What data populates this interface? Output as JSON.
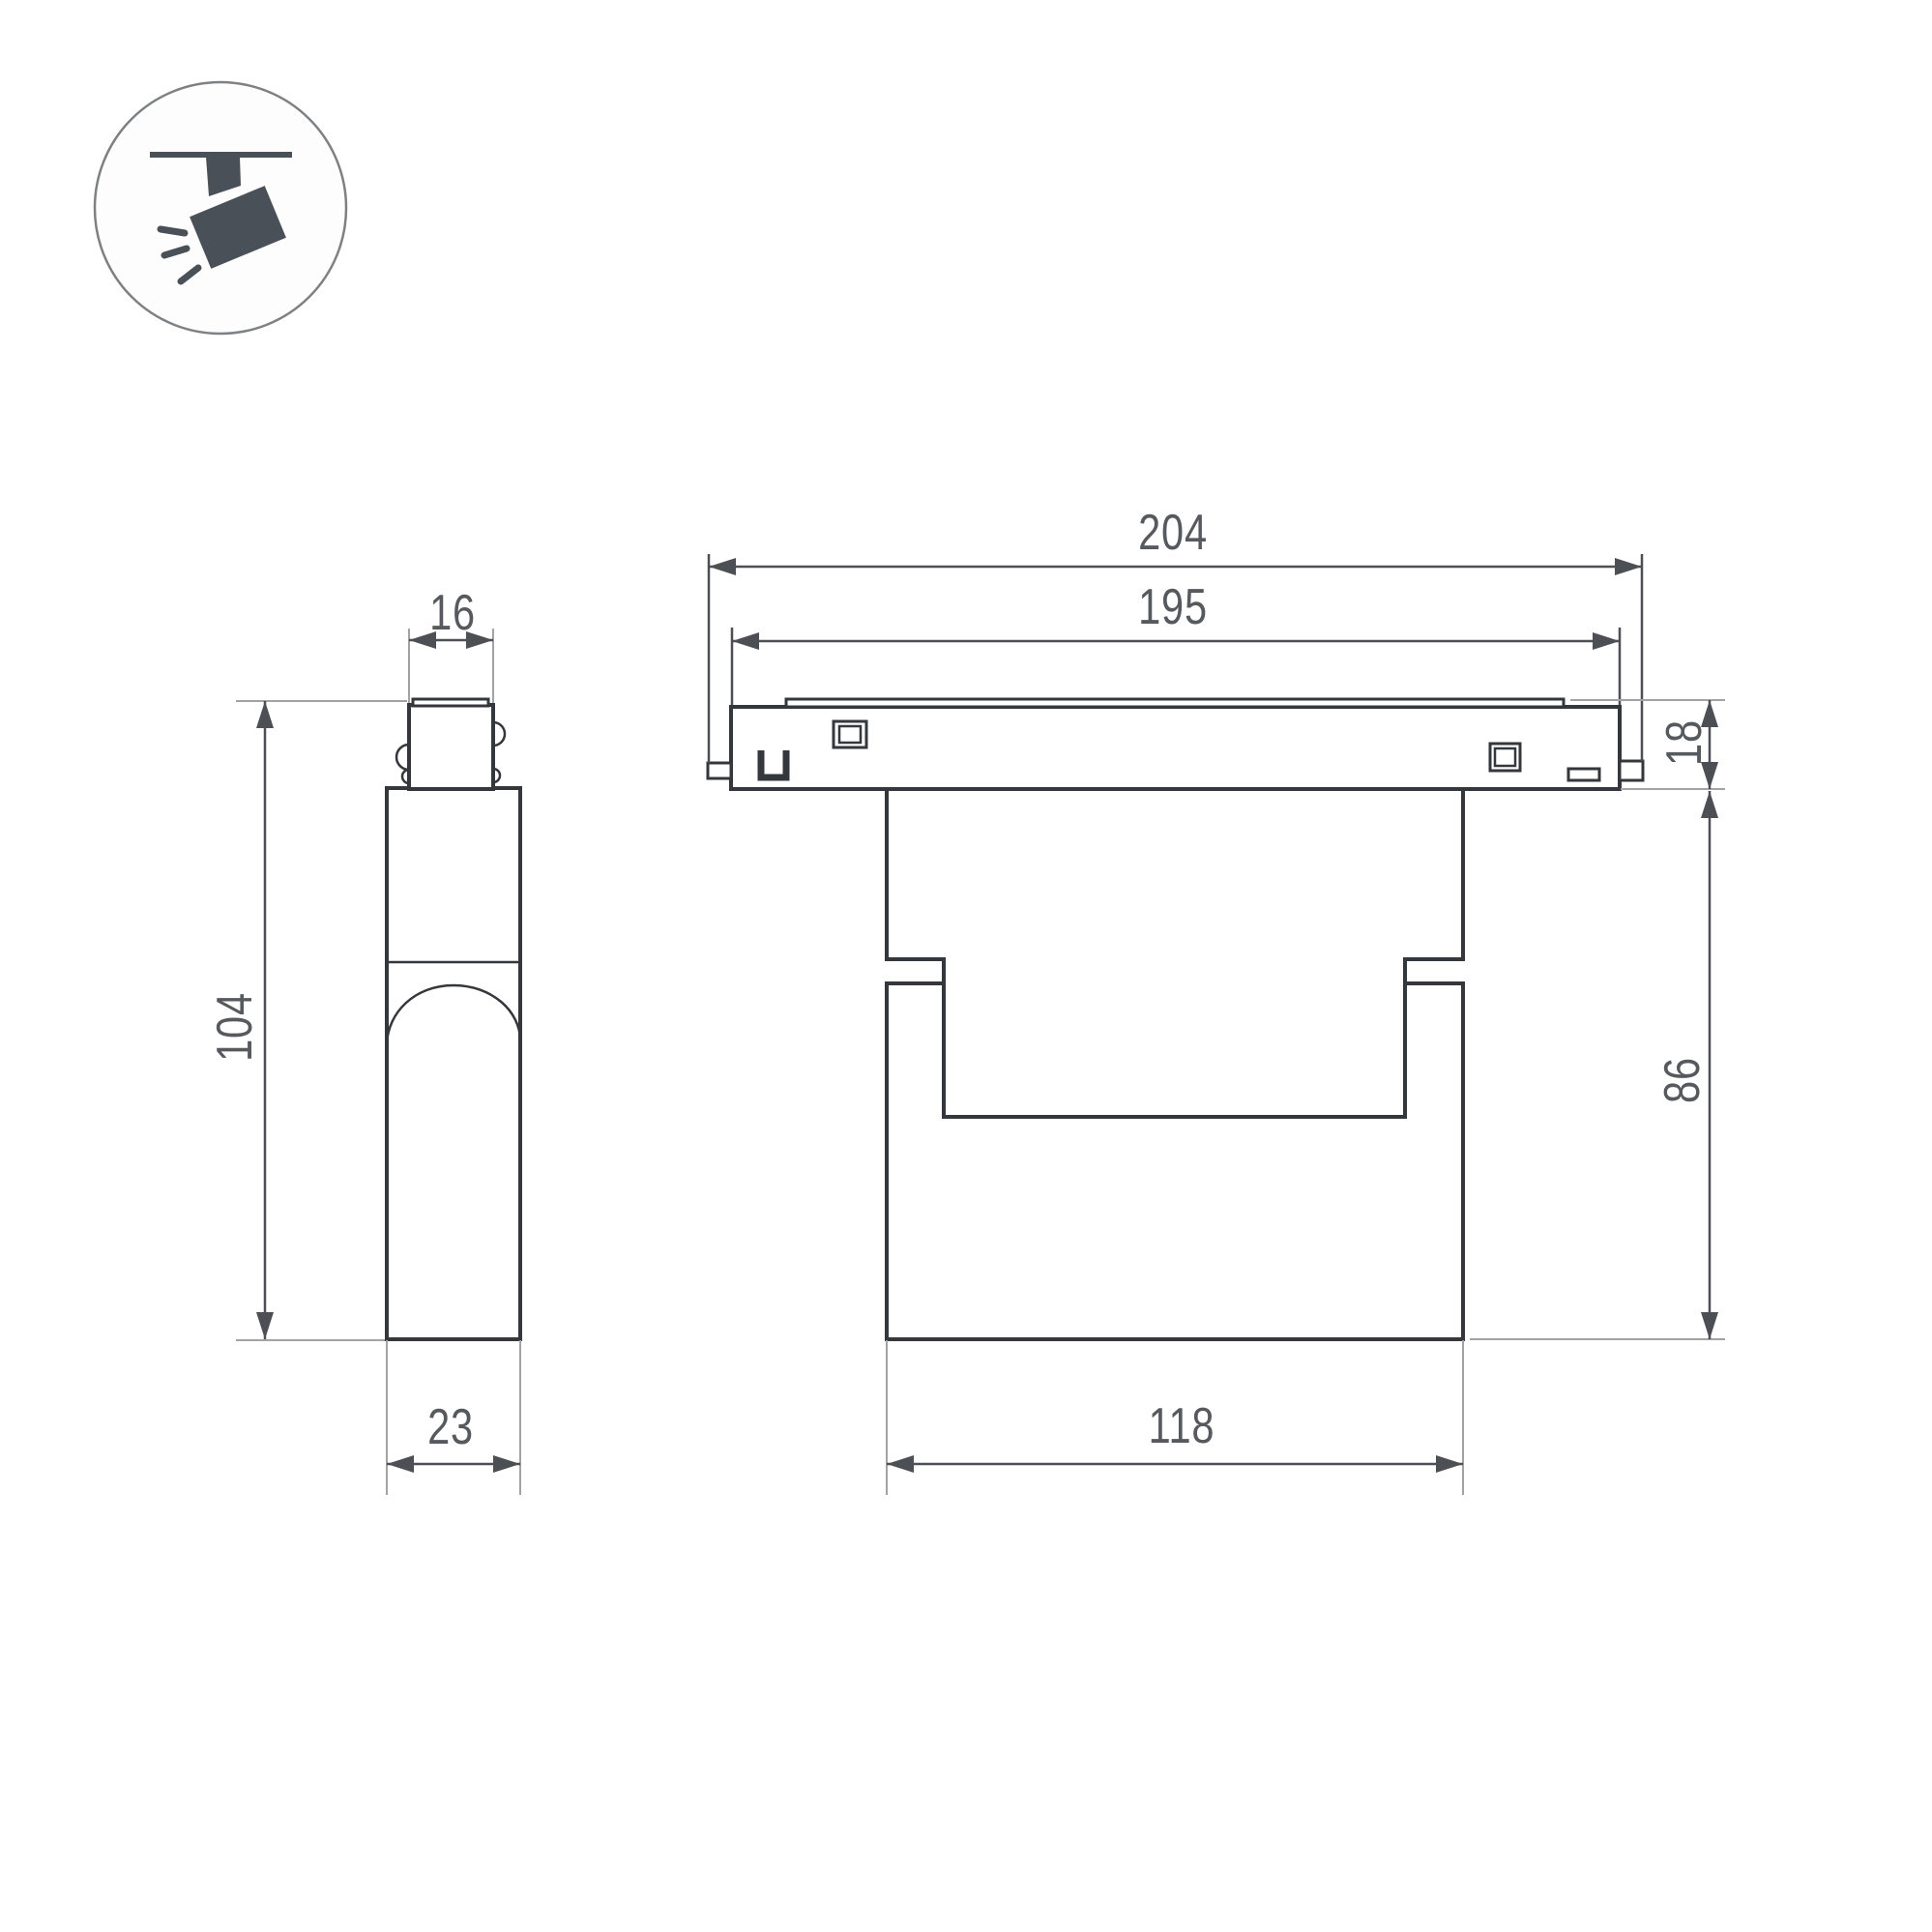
{
  "icon": {
    "name": "ceiling-track-spotlight-icon"
  },
  "views": {
    "side": {
      "dims": {
        "connector_width_mm": "16",
        "height_mm": "104",
        "depth_mm": "23"
      }
    },
    "front": {
      "dims": {
        "overall_length_mm": "204",
        "track_length_mm": "195",
        "track_height_mm": "18",
        "body_height_mm": "86",
        "head_width_mm": "118"
      }
    }
  },
  "colors": {
    "outline": "#34373b",
    "dimension_line": "#4c4f53",
    "extension_line": "#a3a3a3",
    "dimension_text": "#56595d",
    "icon_fill": "#495057",
    "icon_circle": "#7e8184",
    "background": "#ffffff"
  }
}
